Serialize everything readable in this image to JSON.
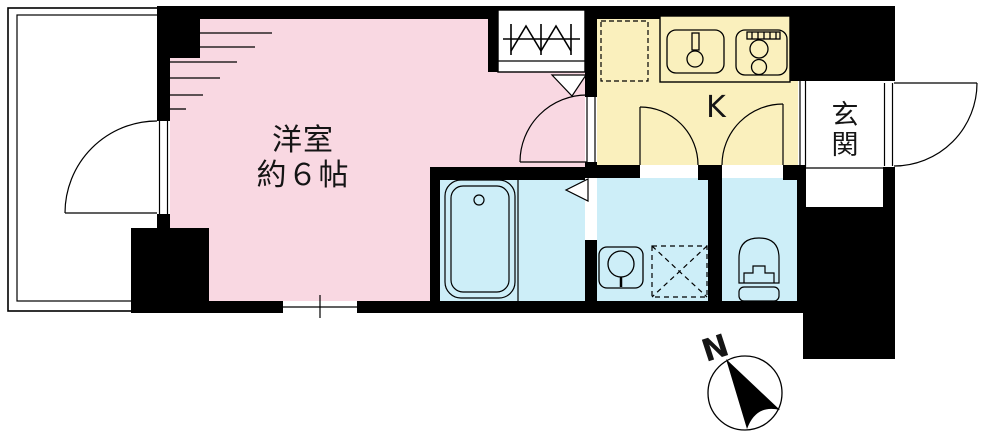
{
  "floor_plan": {
    "rooms": {
      "living": {
        "label_line1": "洋室",
        "label_line2": "約６帖"
      },
      "kitchen": {
        "label": "K"
      },
      "entrance": {
        "label_char_top": "玄",
        "label_char_bottom": "関"
      }
    },
    "compass": {
      "label": "N"
    },
    "colors": {
      "room_pink": "#f9d8e2",
      "kitchen_yellow": "#faf0bd",
      "wet_blue": "#cdeef8",
      "wall_black": "#000000",
      "paper_white": "#ffffff"
    }
  }
}
